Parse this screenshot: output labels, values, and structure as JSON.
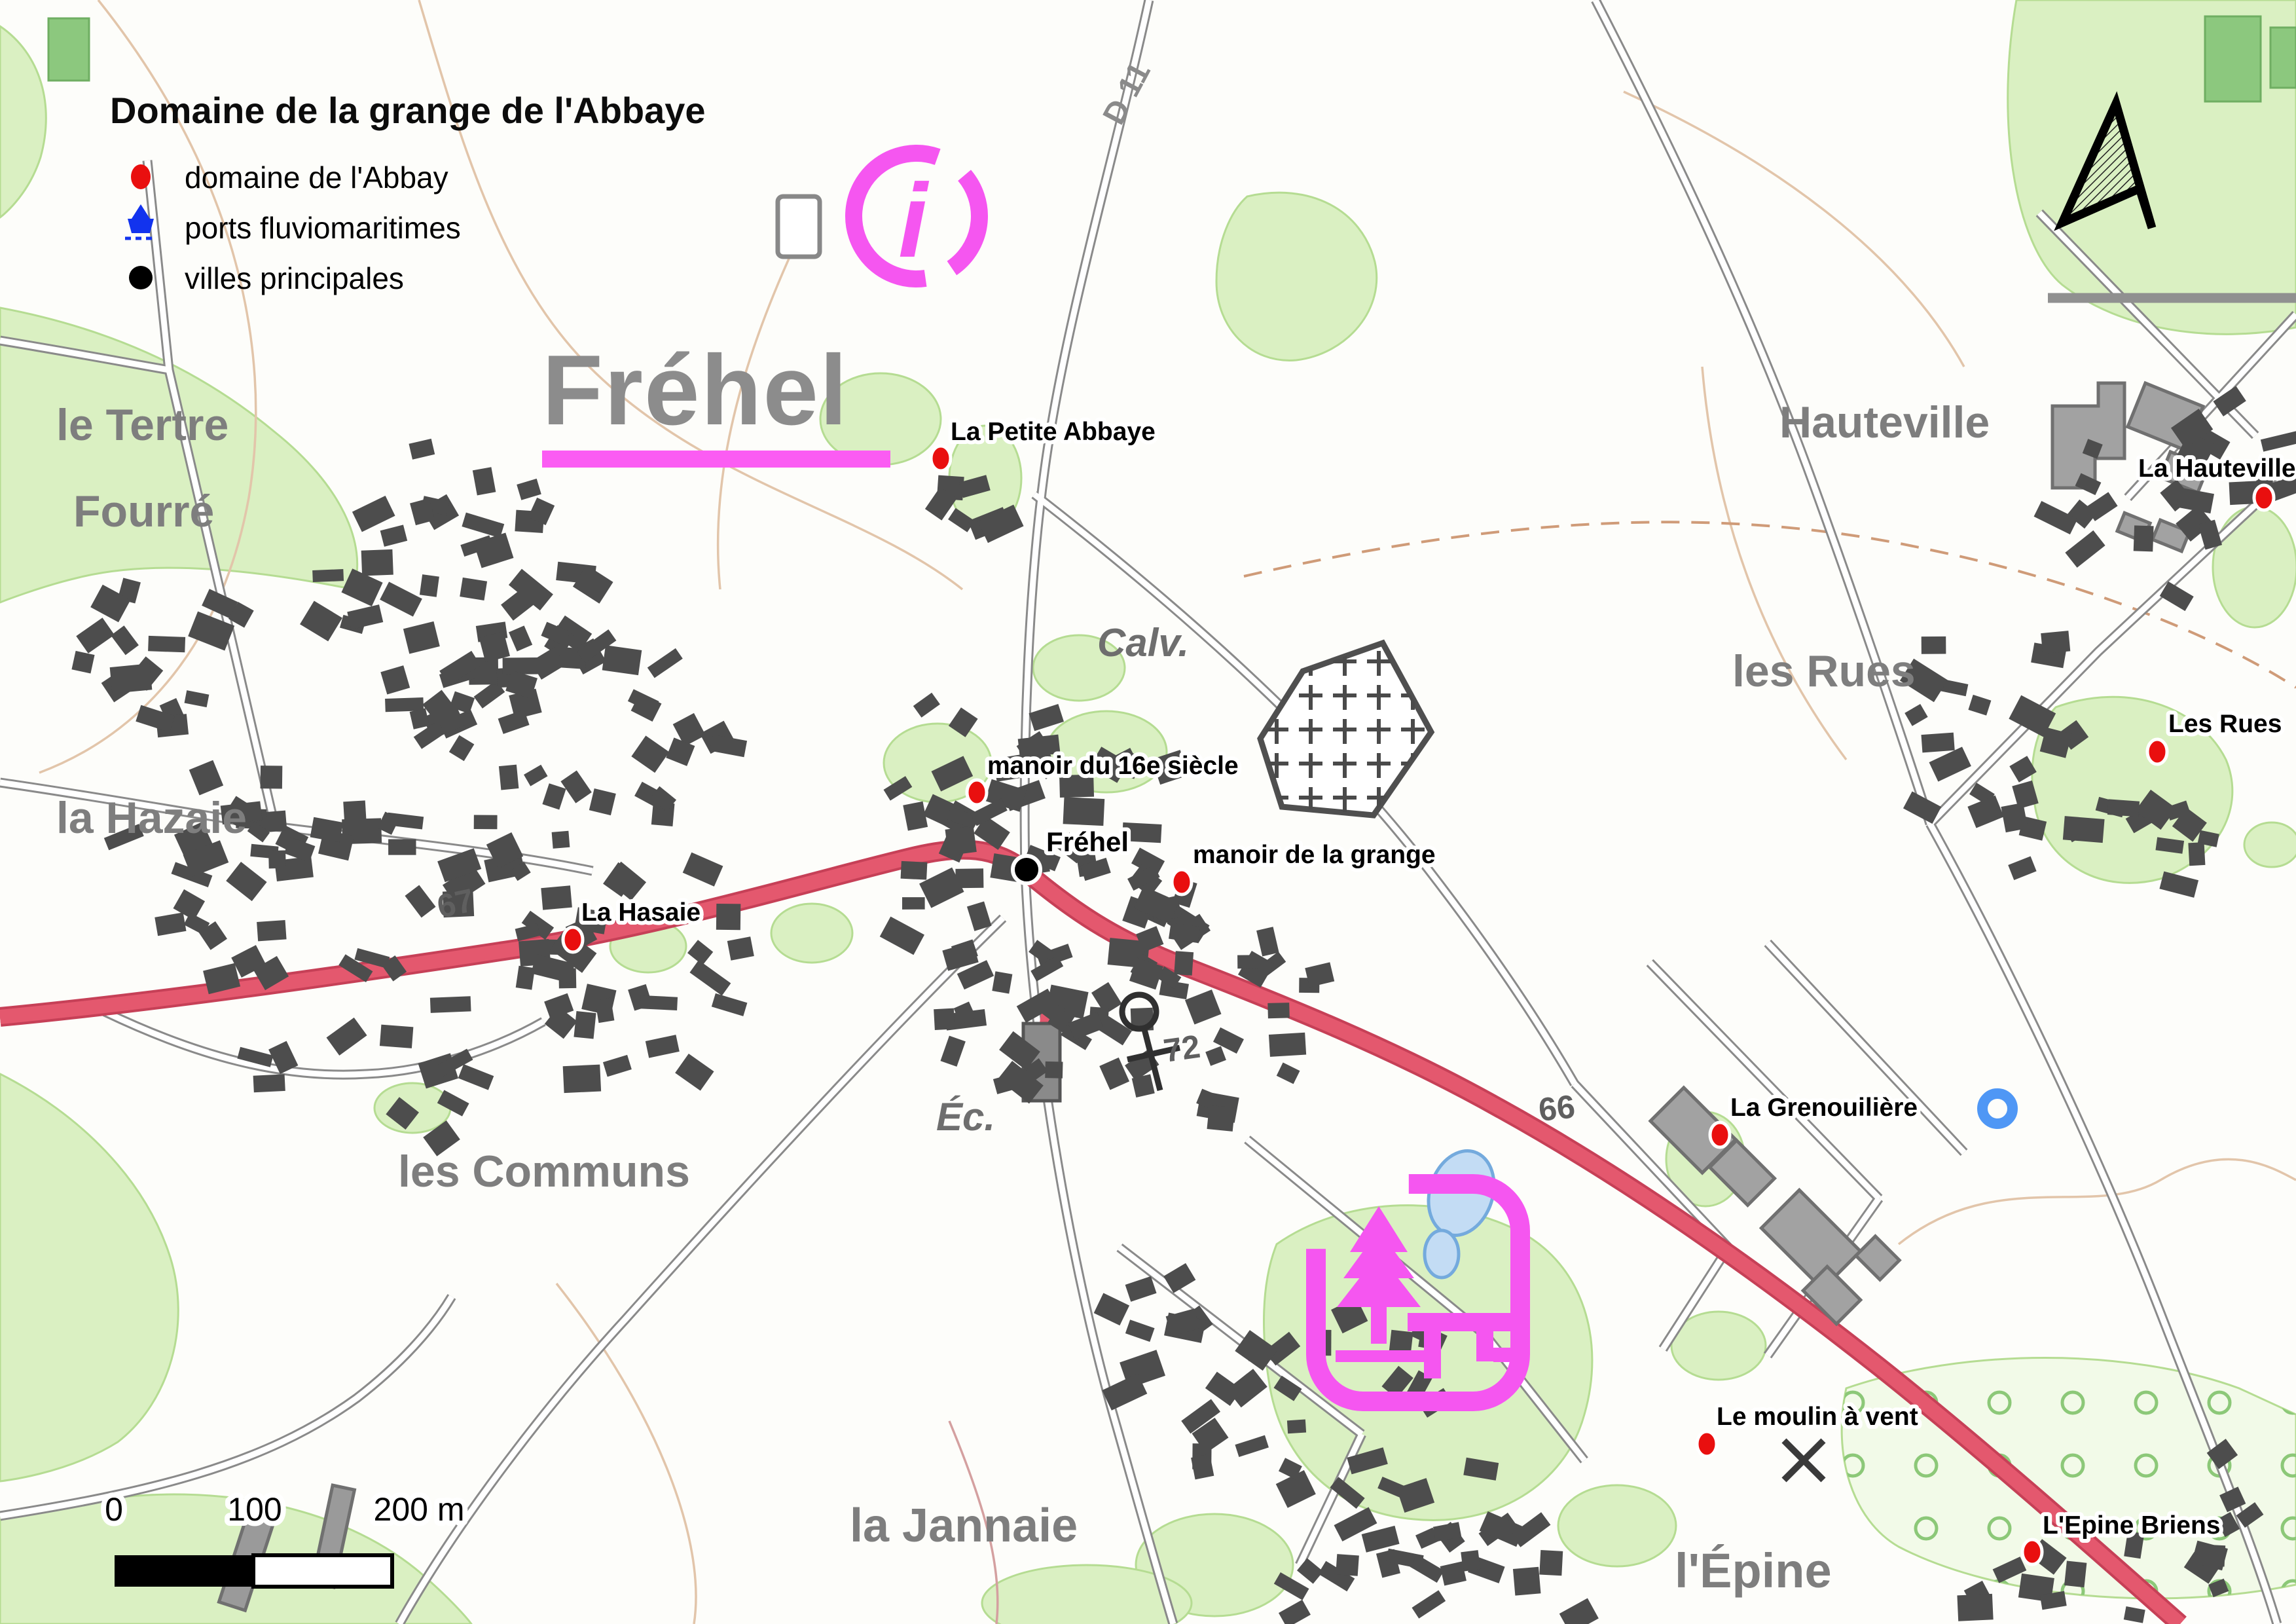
{
  "title": "Domaine de la grange de l'Abbaye",
  "legend": {
    "items": [
      {
        "icon": "red-dot",
        "label": "domaine de l'Abbay"
      },
      {
        "icon": "port-ship",
        "label": "ports fluviomaritimes"
      },
      {
        "icon": "black-dot",
        "label": "villes principales"
      }
    ]
  },
  "city": {
    "big_label": "Fréhel",
    "dot_label": "Fréhel"
  },
  "pois": [
    {
      "label": "La Petite Abbaye"
    },
    {
      "label": "manoir du 16e siècle"
    },
    {
      "label": "manoir de la grange"
    },
    {
      "label": "La Hasaie"
    },
    {
      "label": "La Hauteville"
    },
    {
      "label": "Les Rues"
    },
    {
      "label": "La Grenouilière"
    },
    {
      "label": "Le moulin à vent"
    },
    {
      "label": "L'Epine Briens"
    }
  ],
  "places": [
    {
      "label": "le Tertre"
    },
    {
      "label": "Fourré"
    },
    {
      "label": "la Hazaie"
    },
    {
      "label": "les Communs"
    },
    {
      "label": "la Jannaie"
    },
    {
      "label": "Hauteville"
    },
    {
      "label": "les Rues"
    },
    {
      "label": "l'Épine"
    },
    {
      "label": "Calv."
    },
    {
      "label": "Éc."
    },
    {
      "label": "D 11"
    },
    {
      "label": "67"
    },
    {
      "label": "72"
    },
    {
      "label": "66"
    }
  ],
  "scalebar": {
    "labels": [
      "0",
      "100",
      "200 m"
    ]
  },
  "colors": {
    "poi_red": "#e90f0f",
    "city_black": "#000000",
    "major_road_fill": "#e4586e",
    "major_road_casing": "#c64057",
    "magenta": "#f556f0",
    "legend_port_blue": "#1233ee",
    "place_gray": "#7e7e7e",
    "vegetation": "#daf0c2"
  }
}
